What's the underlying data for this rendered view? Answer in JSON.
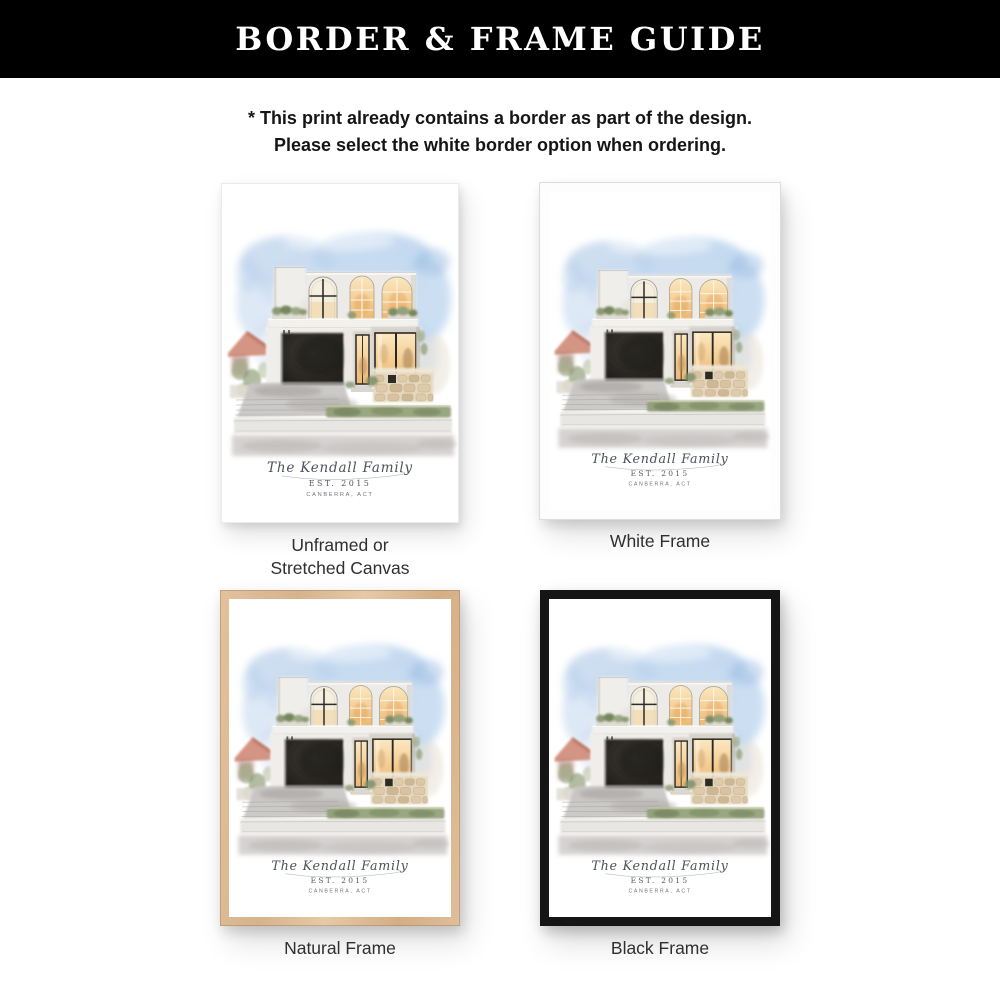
{
  "header": {
    "title": "BORDER & FRAME GUIDE",
    "background_color": "#000000",
    "text_color": "#ffffff"
  },
  "note": {
    "line1": "* This print already contains a border as part of the design.",
    "line2": "Please select the white border option when ordering."
  },
  "artwork": {
    "subject": "watercolor-house-portrait",
    "caption_name": "The Kendall Family",
    "caption_est": "EST. 2015",
    "caption_location": "CANBERRA, ACT",
    "sky_color": "#b5cde9",
    "window_glow_color": "#f2c88a",
    "garage_color": "#2a2724",
    "hedge_color": "#8f9e75",
    "stone_color": "#e4d7bd"
  },
  "options": [
    {
      "id": "unframed",
      "label": "Unframed or\nStretched Canvas",
      "frame_color": "none"
    },
    {
      "id": "white-frame",
      "label": "White Frame",
      "frame_color": "#fdfdfd"
    },
    {
      "id": "natural-frame",
      "label": "Natural Frame",
      "frame_color": "#dcba94"
    },
    {
      "id": "black-frame",
      "label": "Black Frame",
      "frame_color": "#151515"
    }
  ]
}
